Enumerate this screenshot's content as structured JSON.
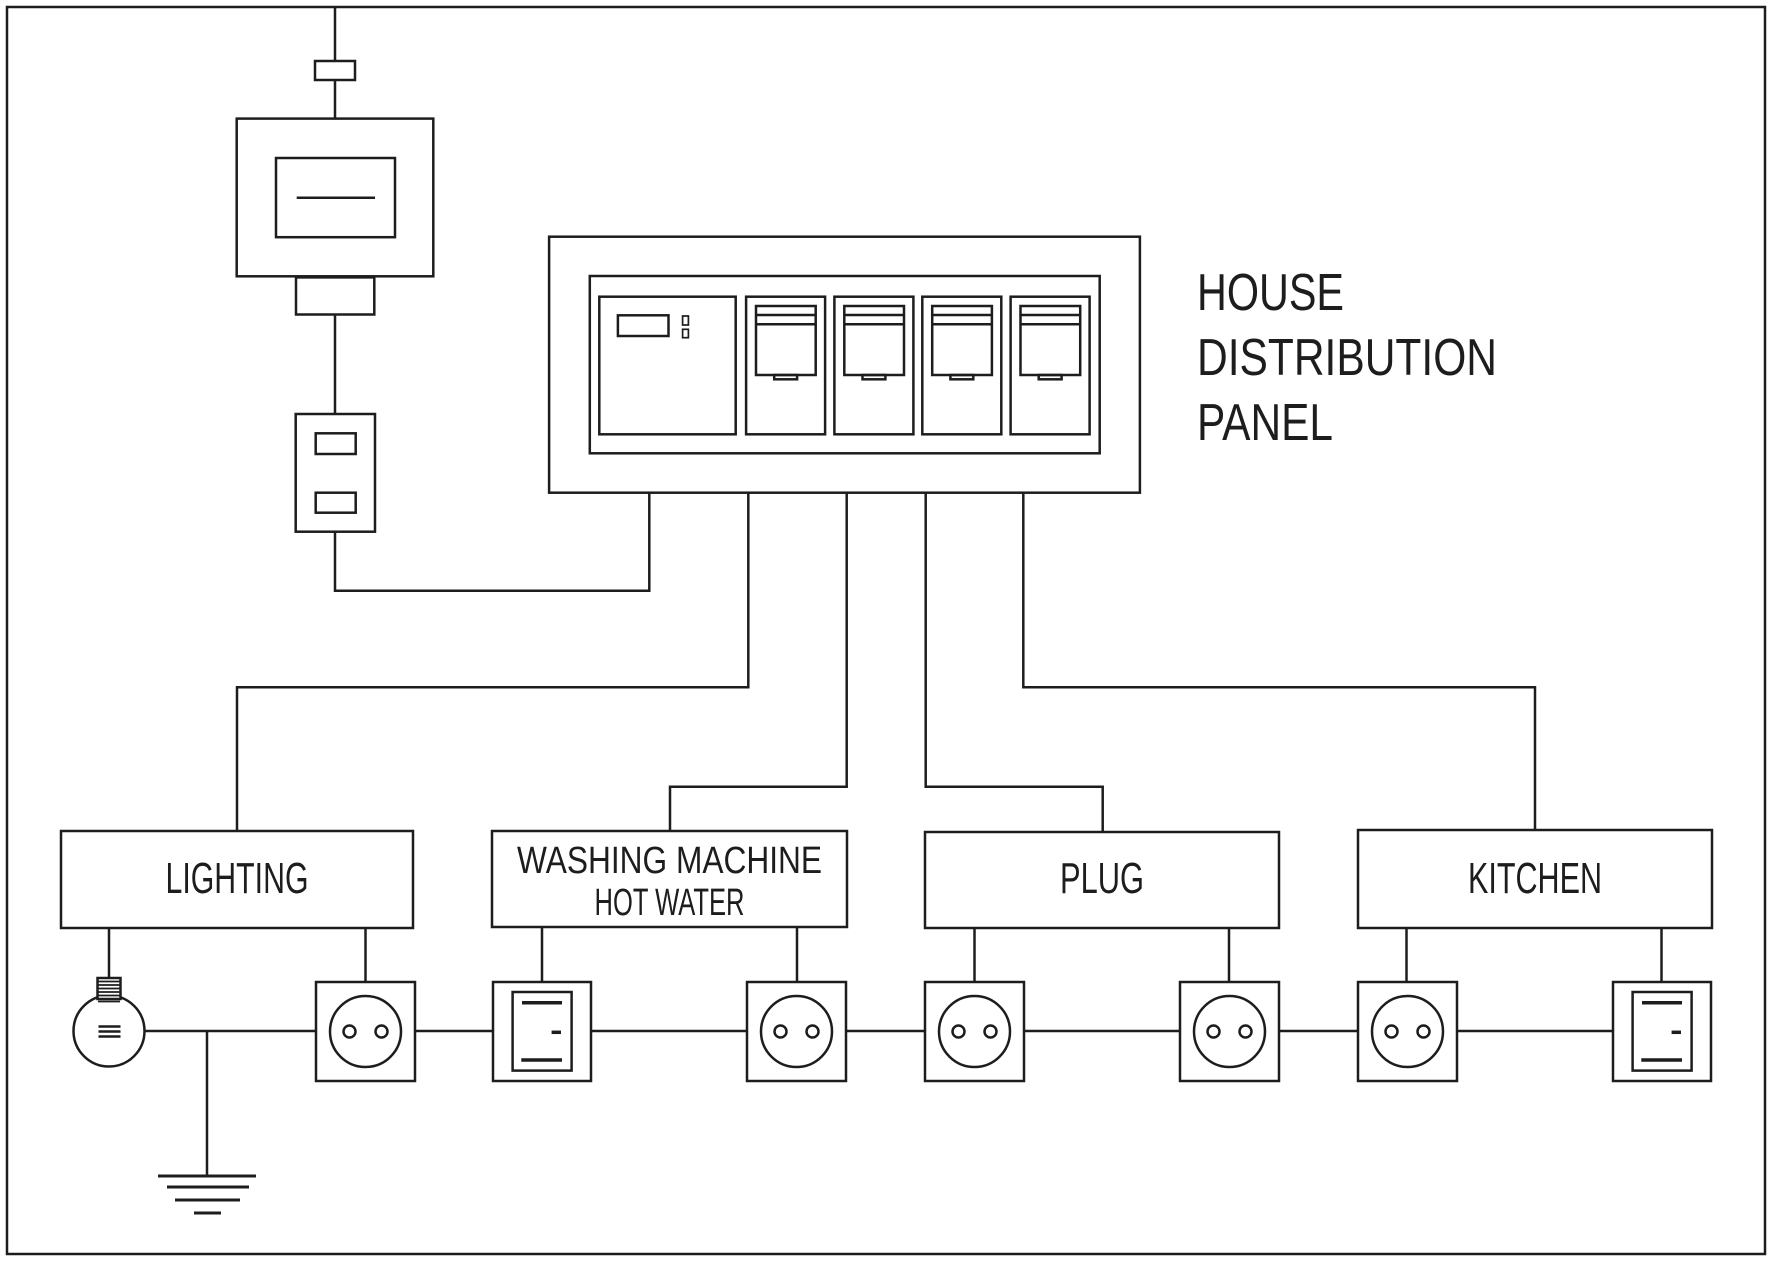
{
  "diagram": {
    "background": "#ffffff",
    "line_color": "#1d1d1d",
    "panel": {
      "title_lines": [
        "HOUSE",
        "DISTRIBUTION",
        "PANEL"
      ],
      "breaker_count": 4
    },
    "circuits": [
      {
        "id": "lighting",
        "label": "LIGHTING"
      },
      {
        "id": "washing-machine-hot-water",
        "label_line1": "WASHING MACHINE",
        "label_line2": "HOT WATER"
      },
      {
        "id": "plug",
        "label": "PLUG"
      },
      {
        "id": "kitchen",
        "label": "KITCHEN"
      }
    ],
    "symbols": {
      "supply": [
        "pole-transformer-icon",
        "insulator-icon",
        "energy-meter-icon"
      ],
      "devices": [
        "light-bulb-icon",
        "earth-ground-icon",
        "wall-socket-icon",
        "rocker-switch-icon"
      ]
    }
  }
}
